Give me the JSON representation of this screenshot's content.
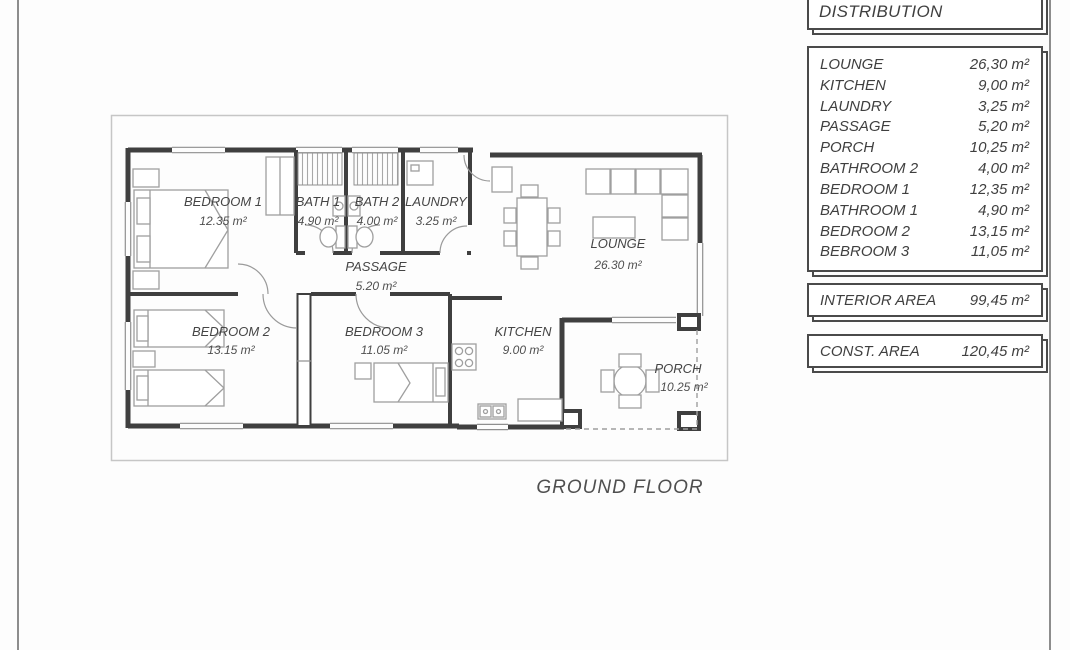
{
  "page": {
    "ground_floor_label": "GROUND FLOOR"
  },
  "distribution_panel": {
    "title": "DISTRIBUTION",
    "rows": [
      {
        "label": "LOUNGE",
        "value": "26,30 m²"
      },
      {
        "label": "KITCHEN",
        "value": "9,00 m²"
      },
      {
        "label": "LAUNDRY",
        "value": "3,25 m²"
      },
      {
        "label": "PASSAGE",
        "value": "5,20 m²"
      },
      {
        "label": "PORCH",
        "value": "10,25 m²"
      },
      {
        "label": "BATHROOM 2",
        "value": "4,00 m²"
      },
      {
        "label": "BEDROOM 1",
        "value": "12,35 m²"
      },
      {
        "label": "BATHROOM 1",
        "value": "4,90 m²"
      },
      {
        "label": "BEDROOM 2",
        "value": "13,15 m²"
      },
      {
        "label": "BEBROOM 3",
        "value": "11,05 m²"
      }
    ],
    "interior_area": {
      "label": "INTERIOR AREA",
      "value": "99,45 m²"
    },
    "const_area": {
      "label": "CONST. AREA",
      "value": "120,45 m²"
    }
  },
  "floor_plan": {
    "rooms": [
      {
        "name": "BEDROOM 1",
        "area": "12.35 m²"
      },
      {
        "name": "BATH 1",
        "area": "4.90 m²"
      },
      {
        "name": "BATH 2",
        "area": "4.00 m²"
      },
      {
        "name": "LAUNDRY",
        "area": "3.25 m²"
      },
      {
        "name": "LOUNGE",
        "area": "26.30 m²"
      },
      {
        "name": "PASSAGE",
        "area": "5.20 m²"
      },
      {
        "name": "BEDROOM 2",
        "area": "13.15 m²"
      },
      {
        "name": "BEDROOM 3",
        "area": "11.05 m²"
      },
      {
        "name": "KITCHEN",
        "area": "9.00 m²"
      },
      {
        "name": "PORCH",
        "area": "10.25 m²"
      }
    ]
  },
  "colors": {
    "ink": "#3f3f3f",
    "light_ink": "#8f8f8f",
    "furniture": "#9f9f9f",
    "plan_frame": "#c6c6c6",
    "label_text": "#454545"
  }
}
